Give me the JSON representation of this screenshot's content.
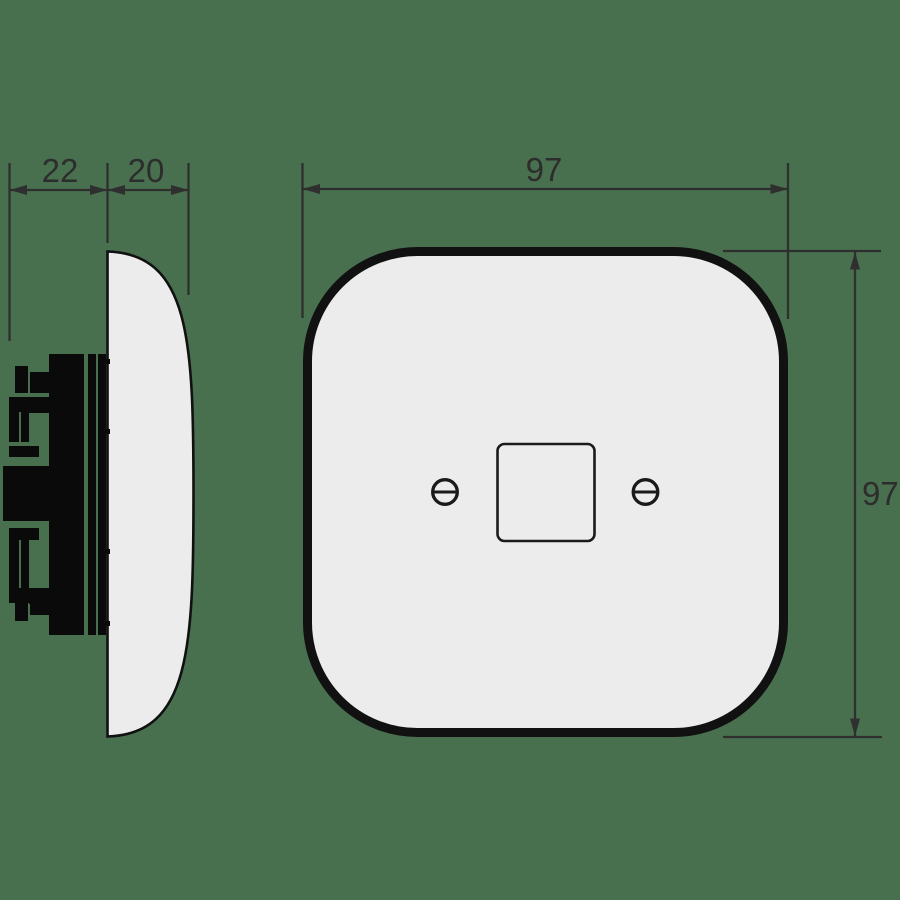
{
  "drawing": {
    "subject": "wall-switch-plate-dimension-drawing",
    "views": {
      "side_view": "switch side profile with flush mechanism",
      "front_view": "rounded square cover plate with central switch cutout and two screws"
    }
  },
  "dimensions": {
    "mechanism_depth": {
      "value": "22"
    },
    "plate_depth": {
      "value": "20"
    },
    "plate_width": {
      "value": "97"
    },
    "plate_height": {
      "value": "97"
    }
  },
  "colors": {
    "bg": "#48704f",
    "dim-line": "#2f2f2f",
    "dim-text": "#2d2d2d",
    "plate-fill": "#ececec",
    "plate-outline": "#111111",
    "detail-outline": "#1a1a1a",
    "mech-fill": "#0a0a0a"
  }
}
